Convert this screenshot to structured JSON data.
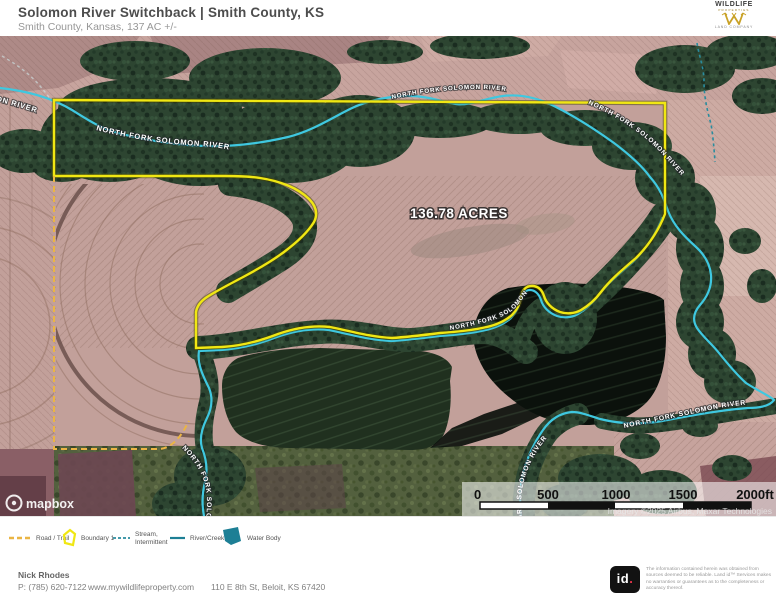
{
  "header": {
    "title": "Solomon River Switchback | Smith County, KS",
    "subtitle": "Smith County, Kansas, 137 AC +/-",
    "logo": {
      "line1": "WILDLIFE",
      "line2": "PROPERTIES",
      "line3": "LAND COMPANY"
    }
  },
  "map": {
    "acreage_label": "136.78 ACRES",
    "river_label": "NORTH FORK SOLOMON RIVER",
    "mapbox_label": "mapbox",
    "imagery_attribution": "Imagery ©2025 Airbus, Maxar Technologies",
    "scale": {
      "labels": [
        "0",
        "500",
        "1000",
        "1500",
        "2000ft"
      ]
    }
  },
  "legend": {
    "items": [
      {
        "label": "Road / Trail"
      },
      {
        "label": "Boundary 1"
      },
      {
        "label_line1": "Stream,",
        "label_line2": "Intermittent"
      },
      {
        "label": "River/Creek"
      },
      {
        "label": "Water Body"
      }
    ]
  },
  "colors": {
    "boundary": "#f0e713",
    "river": "#3fc8e0",
    "stream": "#2a8c9e",
    "road": "#eab544",
    "water_body": "#1d7f95"
  },
  "footer": {
    "agent": "Nick Rhodes",
    "phone": "P: (785) 620-7122",
    "website": "www.mywildlifeproperty.com",
    "address": "110 E 8th St, Beloit, KS 67420",
    "id_mark": "id",
    "disclaimer_1": "The information contained herein was obtained from sources deemed to be reliable.",
    "disclaimer_2": "Land id™ Services makes no warranties or guarantees as to the completeness or accuracy thereof."
  }
}
